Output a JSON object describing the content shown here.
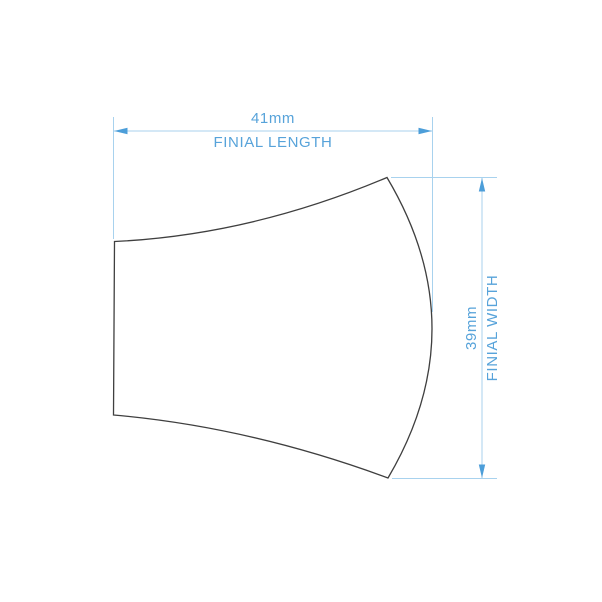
{
  "figure": {
    "name": "finial-profile-outline"
  },
  "dimensions": {
    "length": {
      "value": "41mm",
      "label": "FINIAL LENGTH"
    },
    "width": {
      "value": "39mm",
      "label": "FINIAL WIDTH"
    }
  },
  "colors": {
    "accent_text": "#57a3da",
    "arrow": "#4c9ed9",
    "line": "#a8d2ee",
    "outline": "#3f3f3f",
    "background": "#ffffff"
  }
}
